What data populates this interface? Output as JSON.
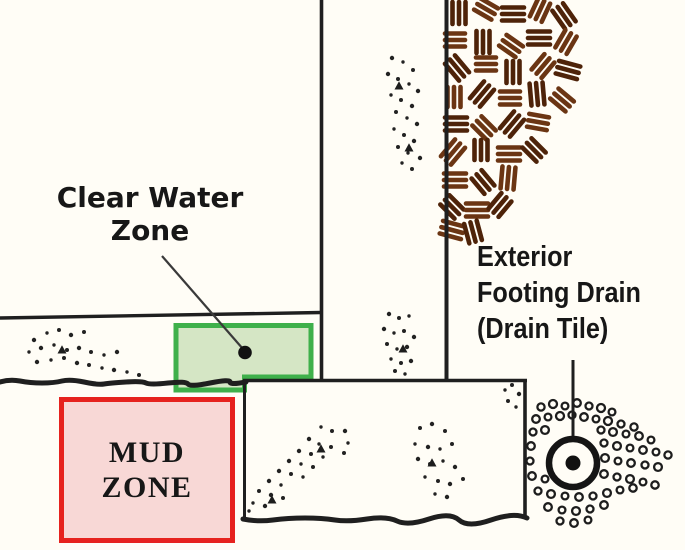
{
  "labels": {
    "clear_water": {
      "line1": "Clear Water",
      "line2": "Zone"
    },
    "mud_zone": {
      "line1": "MUD",
      "line2": "ZONE"
    },
    "exterior_drain": {
      "line1": "Exterior",
      "line2": "Footing Drain",
      "line3": "(Drain Tile)"
    }
  },
  "colors": {
    "background": "#fffdf6",
    "line": "#1f1f1f",
    "text": "#171717",
    "clear_water_zone_fill": "#d5e6c5",
    "clear_water_zone_border": "#3fb04b",
    "mud_zone_fill": "#f8d8d6",
    "mud_zone_border": "#e6221e",
    "backfill_brown_dark": "#4e2309",
    "backfill_brown_light": "#6b3513"
  }
}
